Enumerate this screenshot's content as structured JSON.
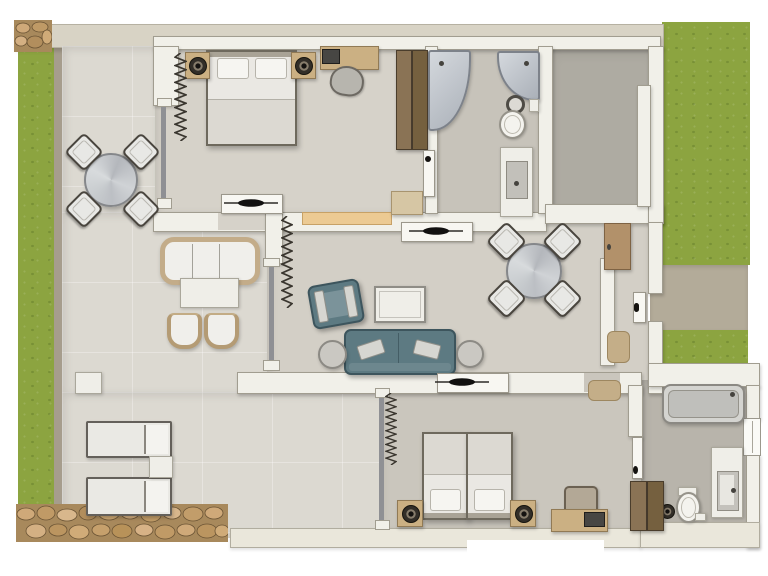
{
  "document": {
    "kind": "architectural floor plan",
    "view": "top-down 3D render of an apartment with terrace and garden",
    "text_labels": []
  },
  "palette": {
    "background": "#ffffff",
    "lawn": "#8ca440",
    "walkway": "#b3ab99",
    "stone": "#c7a473",
    "exterior_wall_band": "#d8d3c5",
    "interior_wall": "#f1f0e9",
    "wall_outline": "#a19d90",
    "terrace_floor": "#dcd9d1",
    "bedroom_floor": "#d6d2c9",
    "bathroom_floor": "#c7c3ba",
    "dark_room_floor": "#aeaba2",
    "living_floor": "#d3cfc6",
    "teal_fabric": "#5d7a82",
    "wood_light": "#cbb083",
    "wood_dark": "#7c6850",
    "counter_wood": "#ecca93",
    "fixture_white": "#efeee8",
    "table_metal_gray": "#c6cacd",
    "handle_black": "#141210"
  },
  "outdoor": {
    "name": "garden",
    "areas": [
      "lawn-left",
      "lawn-right-upper",
      "lawn-right-lower",
      "entry-walkway",
      "stone-path-bottom",
      "stone-patch-top-left"
    ]
  },
  "rooms": {
    "terrace": {
      "name": "terrace",
      "items": [
        "round-dining-table",
        "dining-chair",
        "dining-chair",
        "dining-chair",
        "dining-chair",
        "outdoor-sofa",
        "outdoor-coffee-table",
        "wicker-chair",
        "wicker-chair",
        "square-side-table",
        "sun-lounger",
        "sun-lounger",
        "lounger-side-table"
      ]
    },
    "bedroom_1": {
      "name": "bedroom-1",
      "items": [
        "double-bed",
        "pillow",
        "pillow",
        "nightstand-with-speaker",
        "nightstand-with-speaker",
        "desk",
        "laptop",
        "desk-chair",
        "wardrobe",
        "bench",
        "curtain",
        "door-to-terrace-glass",
        "door-to-bathroom",
        "door-to-living"
      ]
    },
    "bathroom_1": {
      "name": "bathroom-1",
      "items": [
        "corner-shower",
        "corner-shower",
        "round-basin",
        "toilet",
        "vanity-with-sink",
        "paper-holder"
      ]
    },
    "side_room": {
      "name": "adjoining-room",
      "items": [
        "partition-wall"
      ]
    },
    "living_room": {
      "name": "living-dining-room",
      "items": [
        "teal-sofa",
        "sofa-cushion",
        "sofa-cushion",
        "teal-armchair",
        "coffee-table",
        "round-side-table",
        "round-side-table",
        "round-dining-table",
        "dining-chair",
        "dining-chair",
        "dining-chair",
        "dining-chair",
        "pass-through-counter",
        "curtain",
        "glass-front"
      ]
    },
    "entrance_hall": {
      "name": "entrance-hall",
      "items": [
        "sideboard-cabinet",
        "doormat",
        "doormat",
        "entry-door"
      ]
    },
    "bedroom_2": {
      "name": "bedroom-2",
      "items": [
        "twin-bed",
        "twin-bed",
        "pillow",
        "pillow",
        "nightstand-with-speaker",
        "nightstand-with-speaker",
        "desk",
        "monitor",
        "desk-chair",
        "curtain",
        "glass-wall"
      ]
    },
    "bathroom_2": {
      "name": "bathroom-2",
      "items": [
        "bathtub",
        "vanity-with-sink",
        "toilet",
        "round-bin",
        "wardrobe",
        "window",
        "door"
      ]
    }
  }
}
